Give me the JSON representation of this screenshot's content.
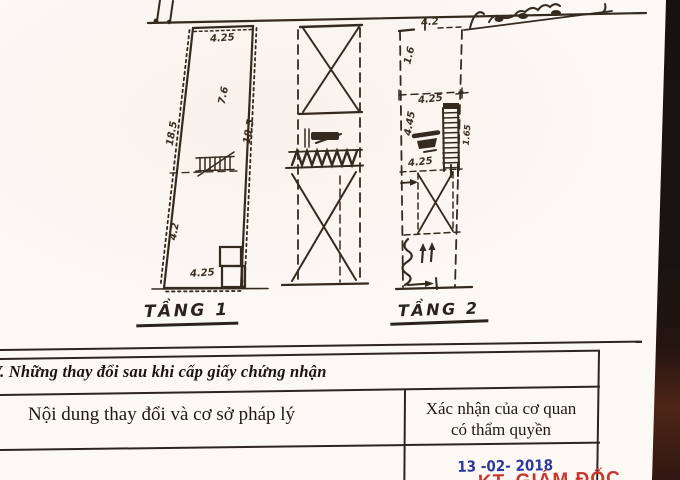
{
  "plans": {
    "floor1": {
      "label": "TẦNG 1",
      "dims": {
        "top": "4.25",
        "upper_left": "7.6",
        "left": "18.5",
        "lower_left": "4.2",
        "right": "18.5",
        "bottom": "4.25"
      }
    },
    "floor2": {
      "label": "TẦNG 2",
      "dims": {
        "top": "4.2",
        "upper_left": "1.6",
        "mid": "4.25",
        "left_mid": "4.45",
        "stair": "1.65",
        "lower": "4.25"
      }
    }
  },
  "section": {
    "title": "V. Những thay đổi sau khi cấp giấy chứng nhận"
  },
  "table": {
    "col1_header": "Nội dung thay đổi và cơ sở pháp lý",
    "col2_header_line1": "Xác nhận của cơ quan",
    "col2_header_line2": "có thẩm quyền"
  },
  "stamps": {
    "date": "13 -02- 2018",
    "approver": "KT. GIÁM ĐỐC",
    "date_color": "#2b3a9e",
    "stamp_red": "#c8372c",
    "ink_color": "#332a20"
  }
}
